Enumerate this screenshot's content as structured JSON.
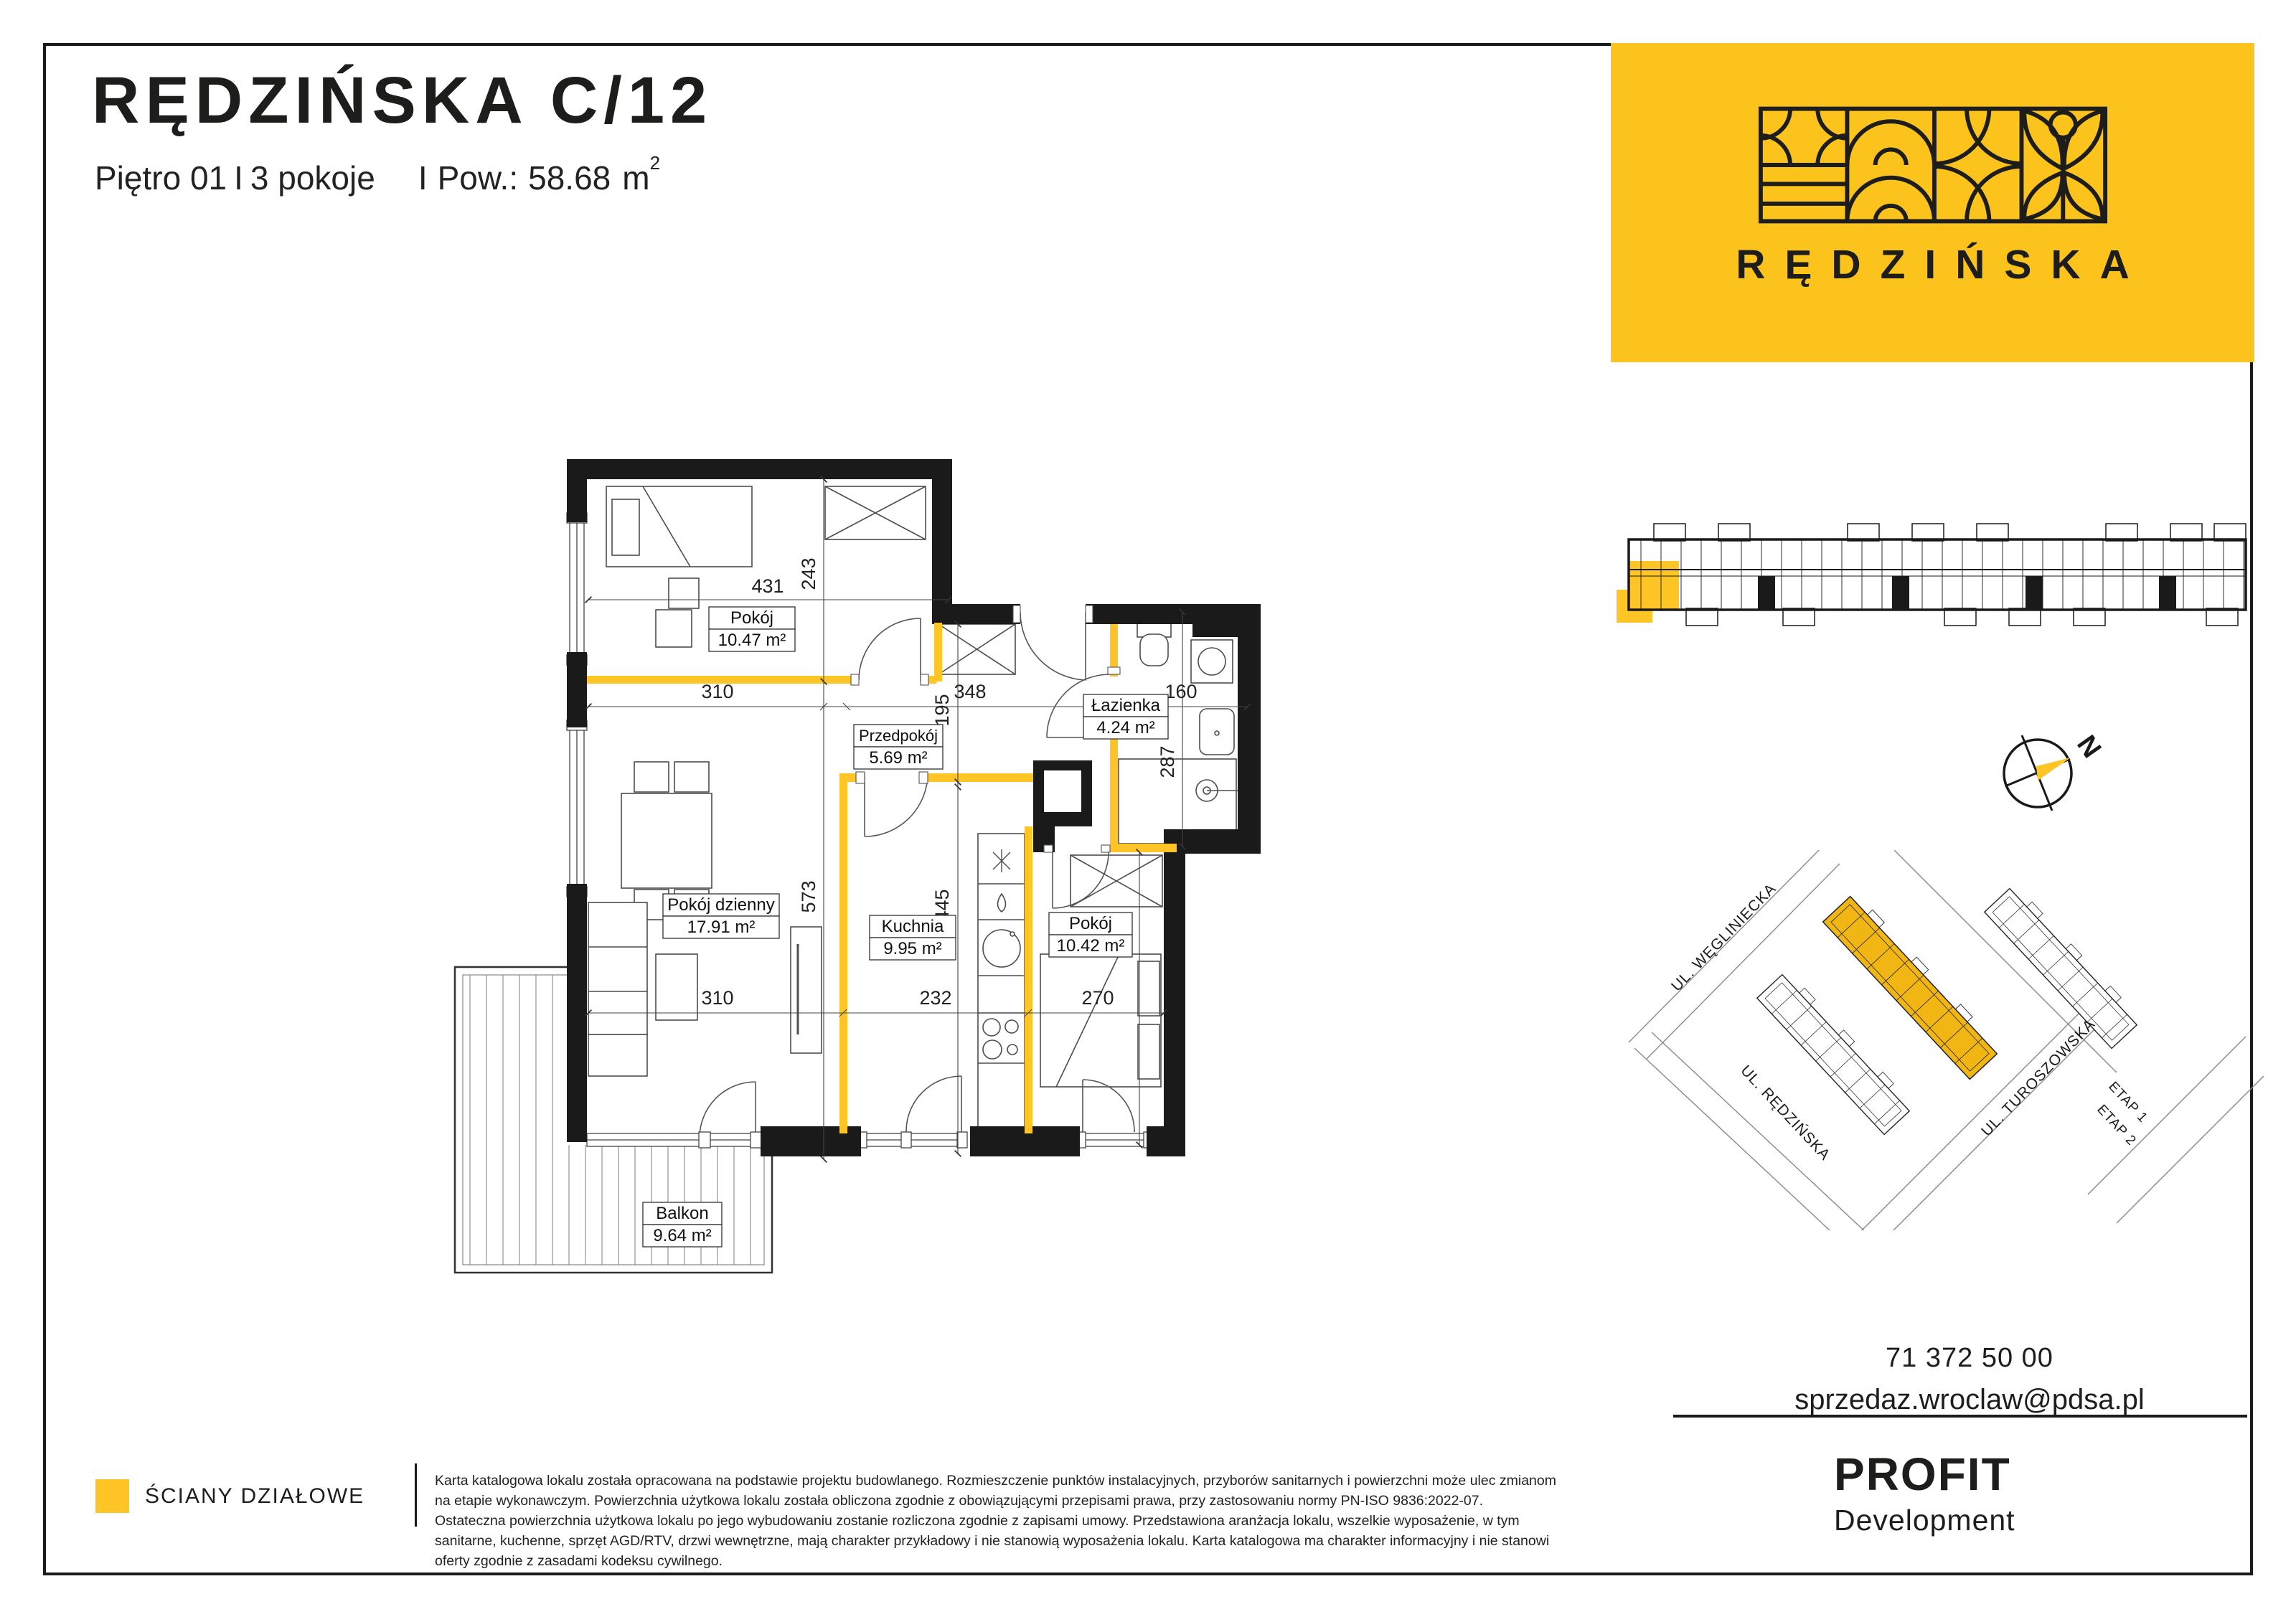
{
  "header": {
    "title": "RĘDZIŃSKA C/12",
    "floor": "Piętro 01",
    "sep": "I",
    "rooms": "3 pokoje",
    "area_label": "Pow.:",
    "area_value": "58.68",
    "area_unit": "m",
    "area_sup": "2"
  },
  "banner": {
    "brand": "RĘDZIŃSKA",
    "bg": "#FBC31C"
  },
  "floorplan": {
    "wall_color": "#1a1a1a",
    "partition_color": "#FFC527",
    "rooms": [
      {
        "name": "Pokój",
        "area": "10.47 m²"
      },
      {
        "name": "Przedpokój",
        "area": "5.69 m²"
      },
      {
        "name": "Łazienka",
        "area": "4.24 m²"
      },
      {
        "name": "Pokój dzienny",
        "area": "17.91 m²"
      },
      {
        "name": "Kuchnia",
        "area": "9.95 m²"
      },
      {
        "name": "Pokój",
        "area": "10.42 m²"
      },
      {
        "name": "Balkon",
        "area": "9.64 m²"
      }
    ],
    "dims": [
      {
        "v": "431"
      },
      {
        "v": "243"
      },
      {
        "v": "310"
      },
      {
        "v": "348"
      },
      {
        "v": "160"
      },
      {
        "v": "195"
      },
      {
        "v": "287"
      },
      {
        "v": "573"
      },
      {
        "v": "445"
      },
      {
        "v": "310"
      },
      {
        "v": "232"
      },
      {
        "v": "270"
      },
      {
        "v": "351"
      }
    ]
  },
  "compass": {
    "north": "N"
  },
  "sitemap": {
    "streets": [
      "UL. WĘGLINIECKA",
      "UL. RĘDZIŃSKA",
      "UL. TUROSZOWSKA"
    ],
    "stages": [
      "ETAP 1",
      "ETAP 2"
    ]
  },
  "contact": {
    "phone": "71 372 50 00",
    "email": "sprzedaz.wroclaw@pdsa.pl"
  },
  "developer": {
    "name": "PROFIT",
    "subname": "Development"
  },
  "legend": {
    "partition_walls": "ŚCIANY DZIAŁOWE"
  },
  "disclaimer": "Karta katalogowa lokalu została opracowana na podstawie projektu budowlanego. Rozmieszczenie punktów instalacyjnych, przyborów sanitarnych i powierzchni może ulec zmianom na etapie wykonawczym. Powierzchnia użytkowa lokalu została obliczona zgodnie z obowiązującymi przepisami prawa, przy zastosowaniu normy PN-ISO 9836:2022-07. Ostateczna powierzchnia użytkowa lokalu po jego wybudowaniu zostanie rozliczona zgodnie z zapisami umowy. Przedstawiona aranżacja lokalu, wszelkie wyposażenie, w tym sanitarne, kuchenne, sprzęt AGD/RTV, drzwi wewnętrzne, mają charakter przykładowy i nie stanowią wyposażenia lokalu. Karta katalogowa ma charakter informacyjny i nie stanowi oferty zgodnie z zasadami kodeksu cywilnego."
}
